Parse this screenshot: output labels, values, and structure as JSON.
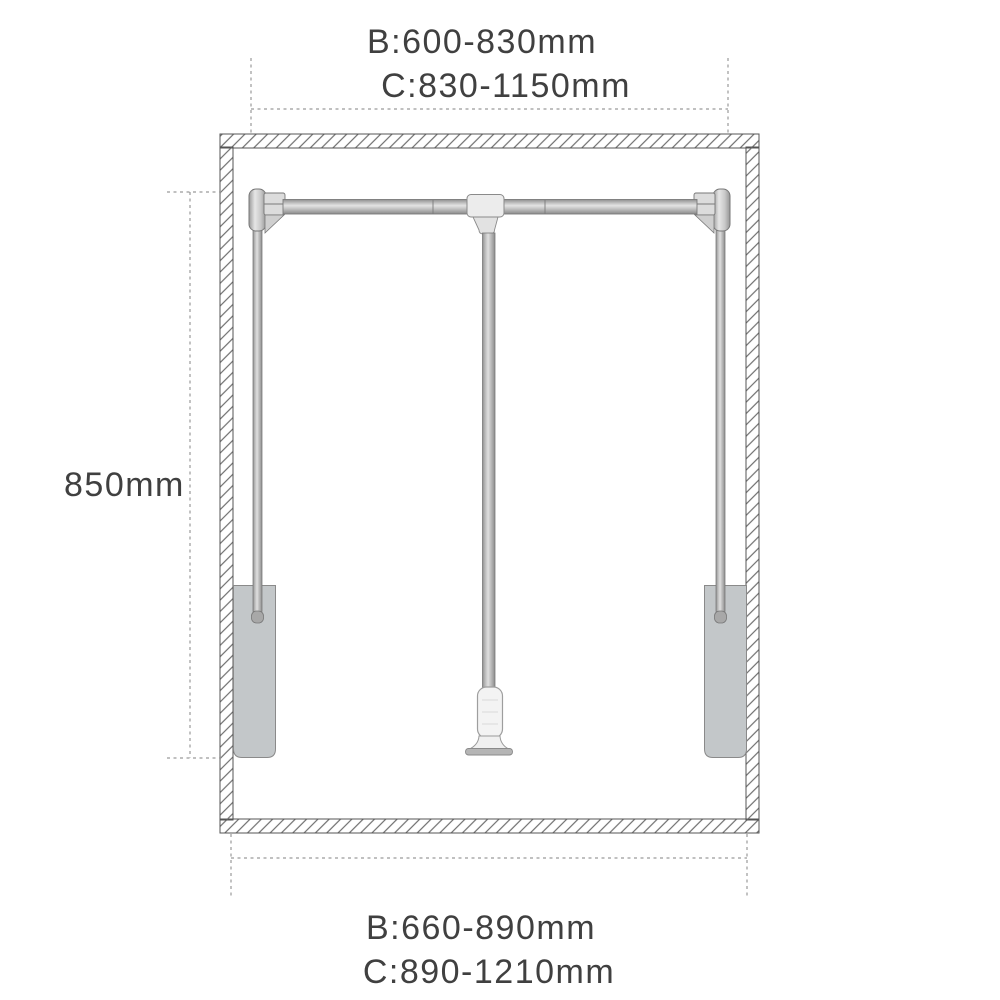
{
  "labels": {
    "top": {
      "line1": "B:600-830mm",
      "line2": "C:830-1150mm"
    },
    "left": {
      "label": "850mm"
    },
    "bottom": {
      "line1": "B:660-890mm",
      "line2": "C:890-1210mm"
    }
  },
  "measurements": {
    "top_width_range_B_mm": [
      600,
      830
    ],
    "top_width_range_C_mm": [
      830,
      1150
    ],
    "height_mm": 850,
    "bottom_width_range_B_mm": [
      660,
      890
    ],
    "bottom_width_range_C_mm": [
      890,
      1210
    ],
    "unit": "mm"
  },
  "colors": {
    "background": "#ffffff",
    "text": "#404040",
    "outline": "#545454",
    "hatch": "#6e6e6e",
    "dashed_line": "#9a9a9a",
    "panel_gray": "#c3c7c9",
    "handle_white": "#f3f3f3",
    "base_gray": "#b5b5b5"
  }
}
